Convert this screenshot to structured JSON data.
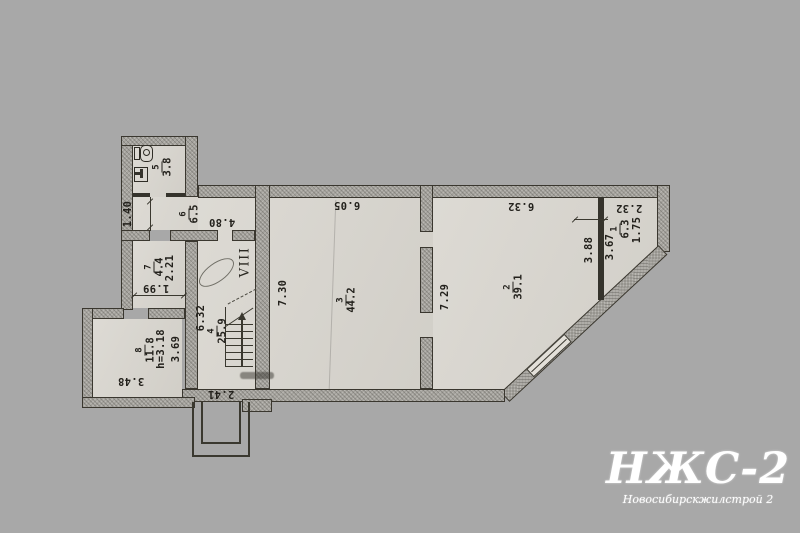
{
  "plan": {
    "section_label": "VIII",
    "rooms": [
      {
        "num": "5",
        "area": "3.8"
      },
      {
        "num": "6",
        "area": "6.5"
      },
      {
        "num": "7",
        "area": "4.4"
      },
      {
        "num": "8",
        "area": "11.8"
      },
      {
        "num": "4",
        "area": "25.9"
      },
      {
        "num": "3",
        "area": "44.2"
      },
      {
        "num": "2",
        "area": "39.1"
      },
      {
        "num": "1",
        "area": "6.3"
      }
    ],
    "dims": [
      {
        "text": "1.40"
      },
      {
        "text": "4.80"
      },
      {
        "text": "2.21"
      },
      {
        "text": "1.99"
      },
      {
        "text": "h=3.18"
      },
      {
        "text": "3.69"
      },
      {
        "text": "3.48"
      },
      {
        "text": "6.32"
      },
      {
        "text": "2.41"
      },
      {
        "text": "6.05"
      },
      {
        "text": "7.30"
      },
      {
        "text": "7.29"
      },
      {
        "text": "6.32"
      },
      {
        "text": "3.88"
      },
      {
        "text": "3.67"
      },
      {
        "text": "2.32"
      },
      {
        "text": "1.75"
      }
    ]
  },
  "watermark": {
    "title": "НЖС-2",
    "subtitle": "Новосибирскжилстрой 2"
  },
  "colors": {
    "background": "#a8a8a8",
    "paper": "#d8d5ce",
    "wall_fill": "#a5a39d",
    "line": "#3a382f",
    "watermark": "#ffffff"
  }
}
